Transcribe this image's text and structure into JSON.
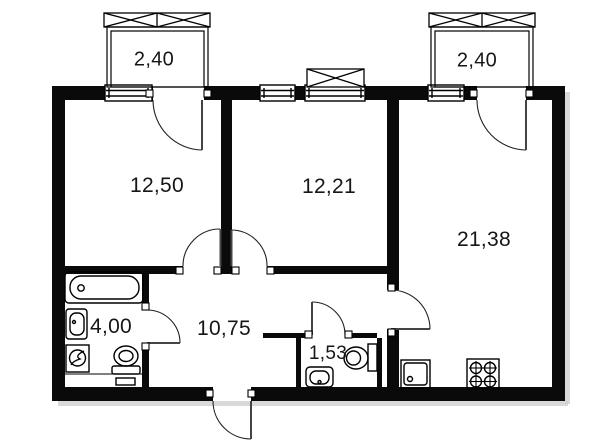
{
  "floor_plan": {
    "rooms": {
      "bedroom_left": {
        "area": "12,50"
      },
      "bedroom_middle": {
        "area": "12,21"
      },
      "living_kitchen": {
        "area": "21,38"
      },
      "bathroom": {
        "area": "4,00"
      },
      "hallway": {
        "area": "10,75"
      },
      "wc": {
        "area": "1,53"
      },
      "balcony_left": {
        "area": "2,40"
      },
      "balcony_right": {
        "area": "2,40"
      }
    },
    "colors": {
      "walls": "#0a0a0a",
      "background": "#ffffff",
      "text": "#161616"
    },
    "fixture_icons": [
      "bathtub-icon",
      "washbasin-icon",
      "washing-machine-icon",
      "toilet-icon",
      "wc-toilet-icon",
      "wc-washbasin-icon",
      "kitchen-sink-icon",
      "stove-icon",
      "window-icon",
      "balcony-railing-icon",
      "door-swing-icon"
    ]
  }
}
